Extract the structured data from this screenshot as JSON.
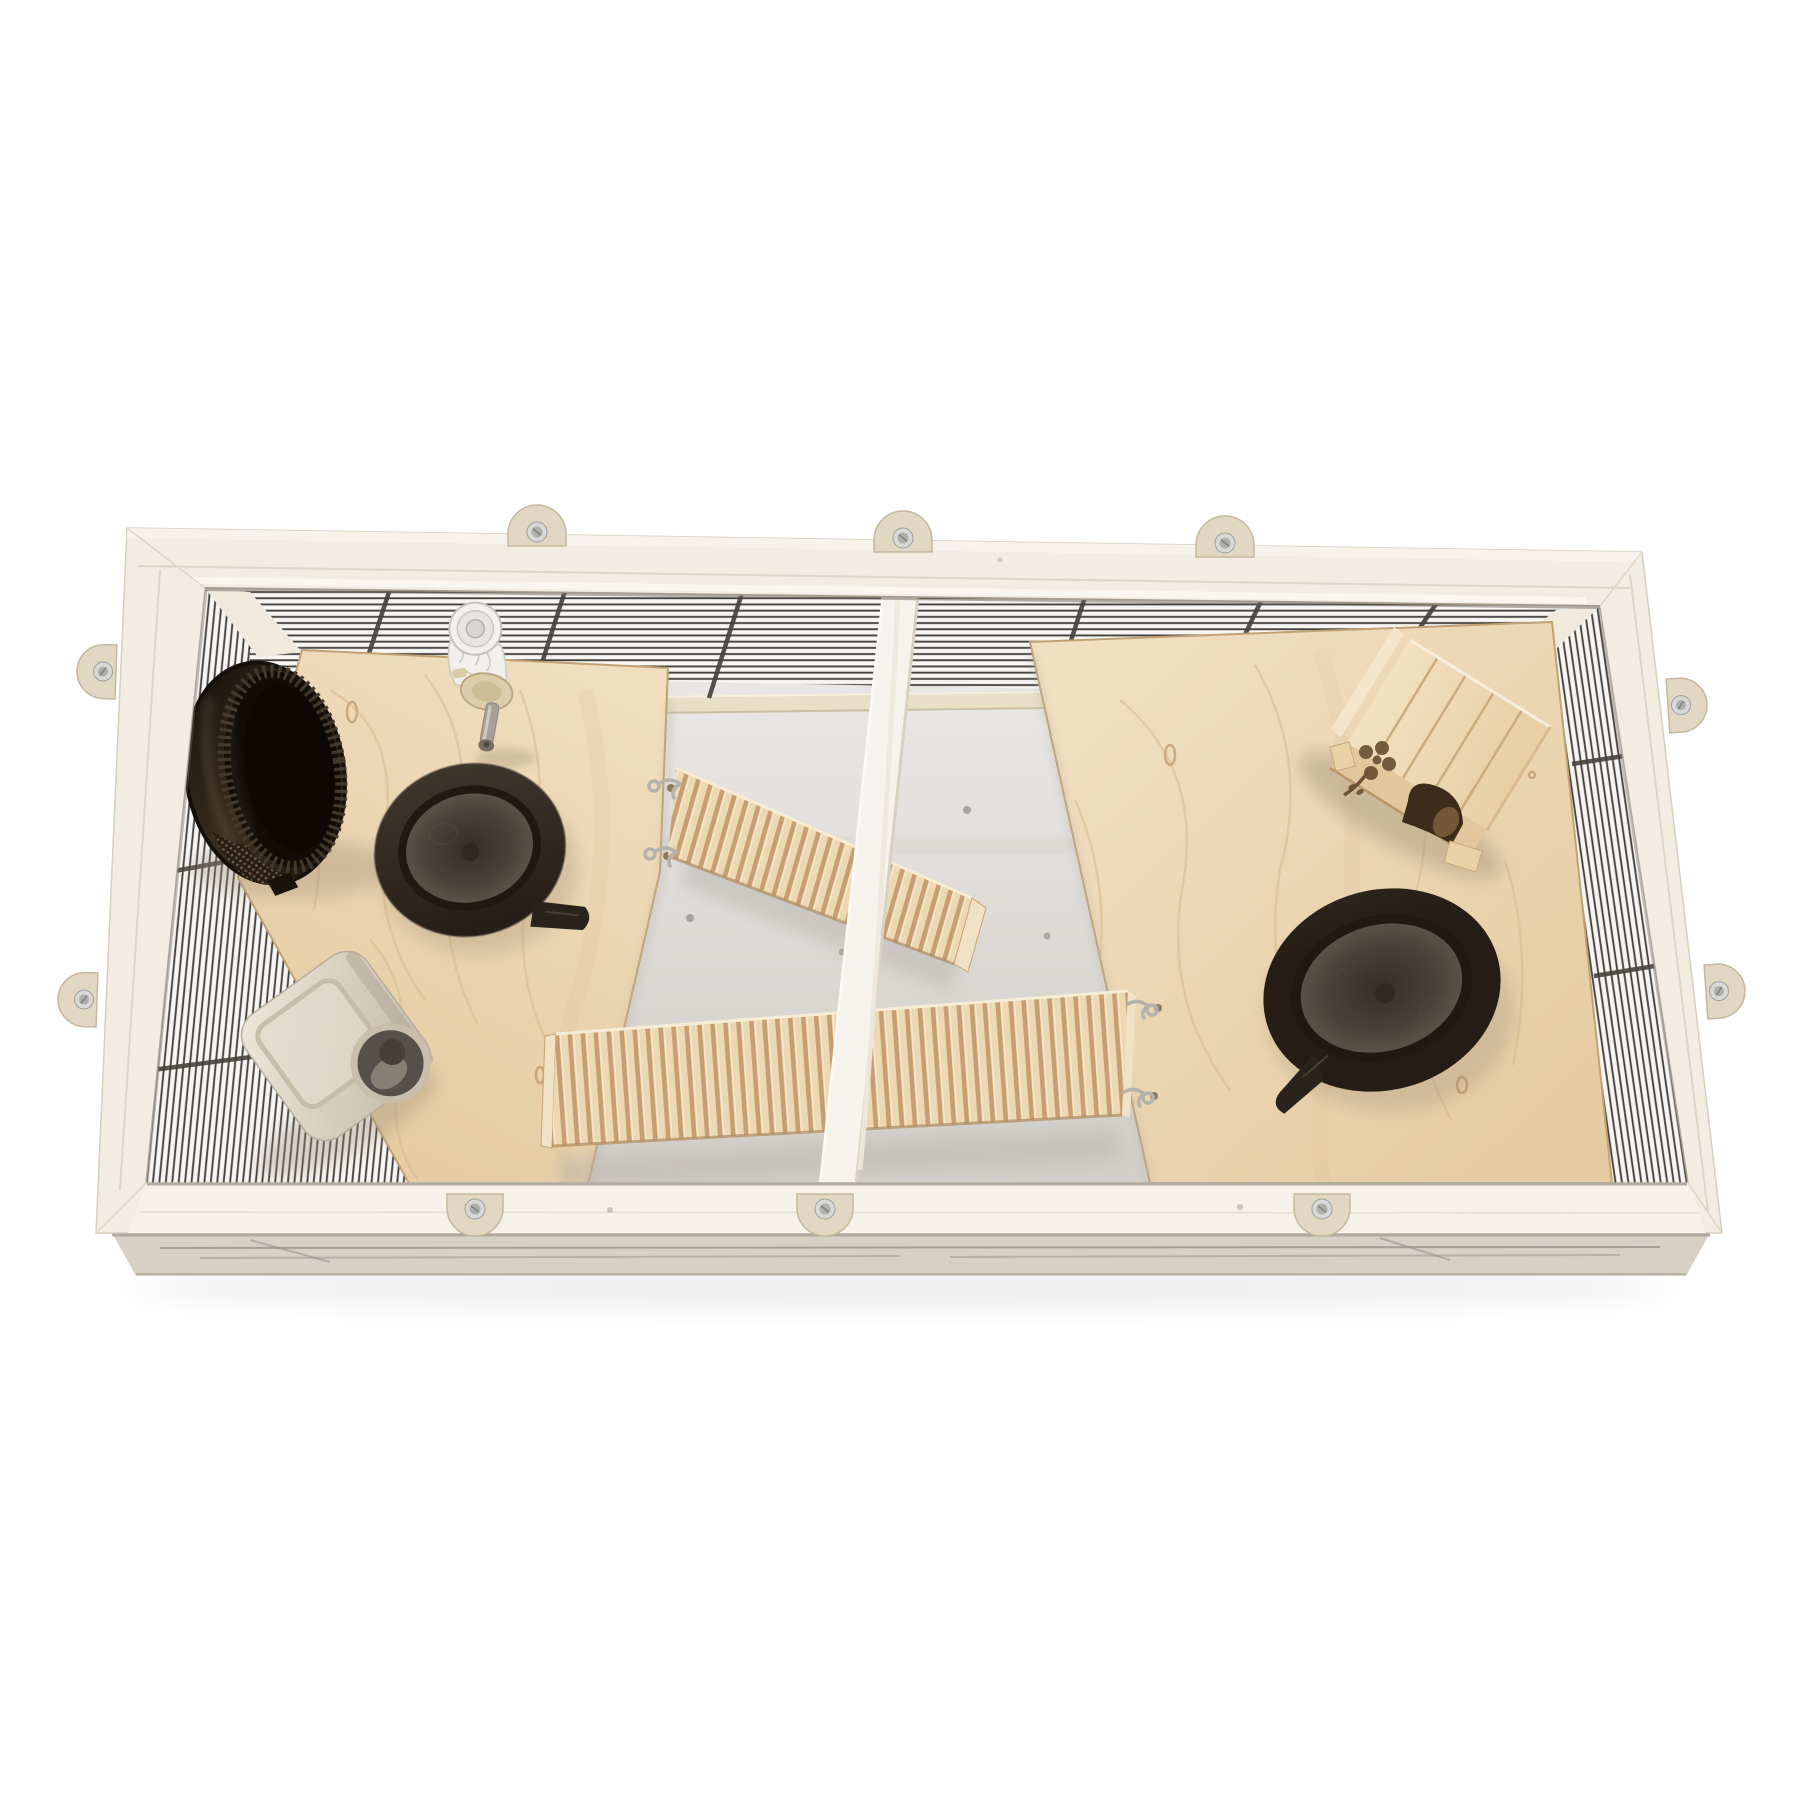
{
  "meta": {
    "kind": "product-photo",
    "description": "Top-down view of a rectangular whitewashed-wood small-animal cage (hamster/gerbil terrarium) with dark wire mesh side panels, two birch plywood platforms, two corrugated wooden ramps on S-hooks, a central wooden divider bar, a dark brown plastic exercise wheel, two dark oval food bowls, a beige plastic feeder box, a transparent water bottle with metal spout, and a birch hideout house with a flower cutout and arched entry. Ten half-round plywood clips with screws fasten the rim.",
    "background": "#ffffff"
  },
  "palette": {
    "background": "#ffffff",
    "frame_wood": "#f2ece2",
    "frame_wood_light": "#f6f1e9",
    "frame_bevel": "#f7f3ec",
    "frame_seam": "#d9d0c0",
    "frame_inner_shadow": "#6e665a",
    "frame_underside": "#d7d0c5",
    "underside_line": "#98938b",
    "clip": "#e2d7c2",
    "clip_edge": "#c6b89e",
    "screw_outer": "#d8d8d6",
    "screw_inner": "#aeaeac",
    "screw_slot": "#82827f",
    "mesh_bg": "#f6f5f3",
    "mesh_wire": "#46423c",
    "corner_post": "#f0e9dc",
    "floor_light": "#edebe9",
    "floor_mid": "#dad7d3",
    "floor_dark": "#d2cfca",
    "wall_rail": "#e9dec6",
    "wall_screw": "#a9a49e",
    "plywood_light": "#f1dfc0",
    "plywood_dark": "#e5cba1",
    "plywood_grain": "#d9ba8e",
    "plywood_edge": "#c2a274",
    "edge_soft_shadow": "#b3aca1",
    "divider_wood": "#f6f3ec",
    "divider_shade": "#d8d0c0",
    "divider_hilite": "#fbf9f5",
    "ramp_light": "#ecd8b2",
    "ramp_dark": "#c79e71",
    "ramp_stripe_hi": "#f5e8cc",
    "ramp_edge_hi": "#f7ecd4",
    "ramp_edge_sh": "#b08c60",
    "ramp_end": "#f0e2c4",
    "hook_metal": "#b5b1ab",
    "hole_dark": "#8d7c5c",
    "wheel_dark1": "#1c140d",
    "wheel_dark2": "#3a2d1f",
    "wheel_inner": "#120c07",
    "wheel_deep": "#0d0804",
    "wheel_tread": "#463a2b",
    "wheel_sheen": "#6e5f4d",
    "wheel_perf_base": "#261c12",
    "wheel_perf_dot": "#7c6c55",
    "bowl_outer1": "#3f362c",
    "bowl_outer2": "#251d15",
    "bowl_rim": "#1f1912",
    "basin_edge": "#5a5246",
    "basin_mid": "#4b4339",
    "basin_center": "#352e26",
    "bowl_tab": "#2a231c",
    "feeder_light": "#eee7db",
    "feeder_dark": "#c2b7a5",
    "feeder_panel": "#c2b7a4",
    "feeder_hole_ring": "#c9beac",
    "feeder_hole": "#57504a",
    "feeder_hole_lite": "#8d8478",
    "bottle_body": "#f2f0ed",
    "bottle_line": "#ccc9c3",
    "bottle_cap": "#dbcda9",
    "bottle_cap_edge": "#bba87f",
    "spout": "#a6a098",
    "spout_tip": "#746e66",
    "house_roof1": "#f2e0be",
    "house_roof2": "#e8cfa6",
    "house_wall": "#e2c69c",
    "house_gap": "#c8a678",
    "house_hole": "#3c2c19",
    "house_hole_lite": "#7d5f3c",
    "house_cut": "#6b5133",
    "house_tab": "#ead2a8",
    "house_sliver": "#f4e6c8",
    "shadow_warm": "#9c8c74",
    "shadow_cool": "#b9b3ab",
    "ground_shadow": "#000000"
  },
  "objects": [
    {
      "id": "cage-frame",
      "label": "whitewashed wooden cage frame, top rim",
      "color": "#f2ece2"
    },
    {
      "id": "mesh-panels",
      "label": "dark wire mesh side panels (back, left, right)",
      "color": "#46423c"
    },
    {
      "id": "fastener-clips",
      "label": "half-round plywood fastener clips with screws",
      "count": 10,
      "color": "#e2d7c2"
    },
    {
      "id": "platform-left",
      "label": "birch plywood platform, left compartment",
      "color": "#eed8b6"
    },
    {
      "id": "platform-right",
      "label": "birch plywood platform, right compartment",
      "color": "#eed8b6"
    },
    {
      "id": "divider-bar",
      "label": "central whitewashed wooden divider bar",
      "color": "#f6f3ec"
    },
    {
      "id": "ramp-upper",
      "label": "corrugated wooden ramp hung on S-hooks from left platform",
      "color": "#ecd8b2"
    },
    {
      "id": "ramp-lower",
      "label": "corrugated wooden ramp hung on S-hooks from right platform",
      "color": "#ecd8b2"
    },
    {
      "id": "exercise-wheel",
      "label": "dark brown plastic exercise wheel, tilted",
      "color": "#1c140d"
    },
    {
      "id": "water-bottle",
      "label": "transparent water bottle with metal drinking spout",
      "color": "#f2f0ed"
    },
    {
      "id": "feeder-box",
      "label": "beige plastic feeder/food box lying on side",
      "color": "#d6cbba"
    },
    {
      "id": "food-bowl-left",
      "label": "dark brown oval food bowl, left platform",
      "color": "#2e2720"
    },
    {
      "id": "food-bowl-right",
      "label": "dark brown oval food bowl, right platform",
      "color": "#2e2720"
    },
    {
      "id": "hideout-house",
      "label": "birch wooden hideout house with plank roof, flower cutout and arched entry",
      "color": "#eed7b2"
    },
    {
      "id": "floor",
      "label": "white painted cage floor visible between platforms",
      "color": "#dad7d3"
    }
  ]
}
